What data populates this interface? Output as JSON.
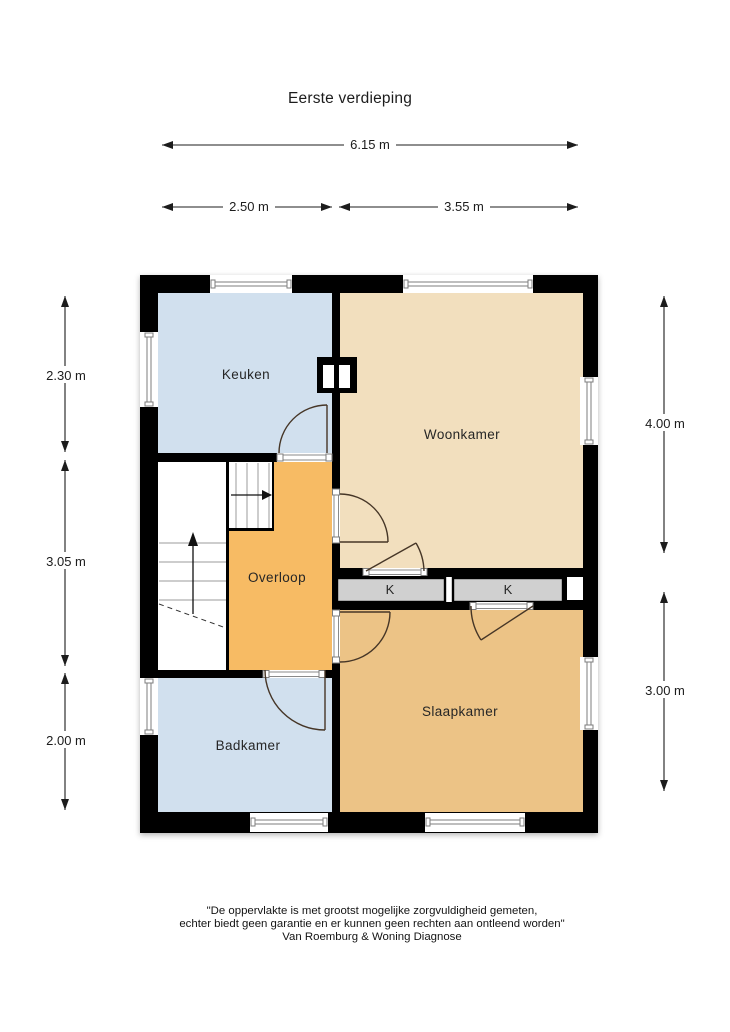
{
  "title": "Eerste verdieping",
  "dimensions": {
    "width_total": "6.15 m",
    "width_left": "2.50 m",
    "width_right": "3.55 m",
    "left_top": "2.30 m",
    "left_middle": "3.05 m",
    "left_bottom": "2.00 m",
    "right_top": "4.00 m",
    "right_bottom": "3.00 m"
  },
  "rooms": {
    "keuken": {
      "label": "Keuken"
    },
    "woonkamer": {
      "label": "Woonkamer"
    },
    "overloop": {
      "label": "Overloop"
    },
    "badkamer": {
      "label": "Badkamer"
    },
    "slaapkamer": {
      "label": "Slaapkamer"
    },
    "closet_left": {
      "label": "K"
    },
    "closet_right": {
      "label": "K"
    }
  },
  "colors": {
    "wall": "#000000",
    "room_blue": "#d1e0ee",
    "room_tan_light": "#f2dfbe",
    "room_tan_dark": "#ecc386",
    "room_orange": "#f7bb64",
    "closet_gray": "#d0d0d0"
  },
  "footer": {
    "line1": "\"De oppervlakte is met grootst mogelijke zorgvuldigheid gemeten,",
    "line2": "echter biedt geen garantie en er kunnen geen rechten aan ontleend worden\"",
    "line3": "Van Roemburg & Woning Diagnose"
  }
}
